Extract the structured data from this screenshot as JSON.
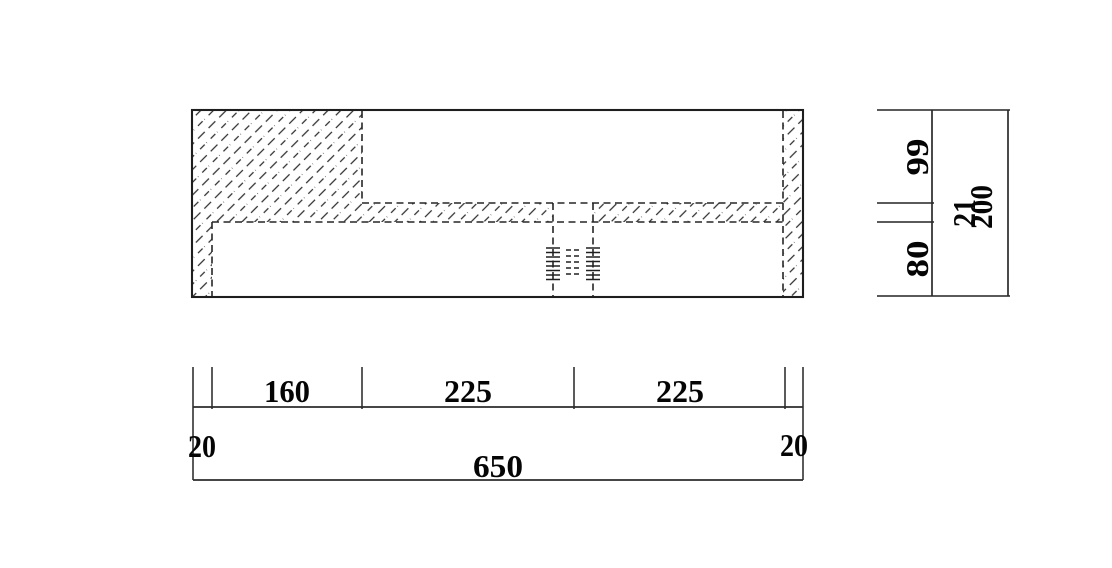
{
  "canvas": {
    "background": "#ffffff",
    "line_color": "#1e1e1e",
    "text_color": "#050505"
  },
  "front_view": {
    "description": "sectioned-front-view-with-hatching-and-hidden-threaded-hole",
    "bottom_dims": {
      "left_wall": "20",
      "block_width": "160",
      "left_bay": "225",
      "right_bay": "225",
      "right_wall": "20",
      "overall_width": "650"
    }
  },
  "side_dims": {
    "upper_height": "99",
    "shelf_thickness": "21",
    "lower_height": "80",
    "overall_height": "200"
  }
}
